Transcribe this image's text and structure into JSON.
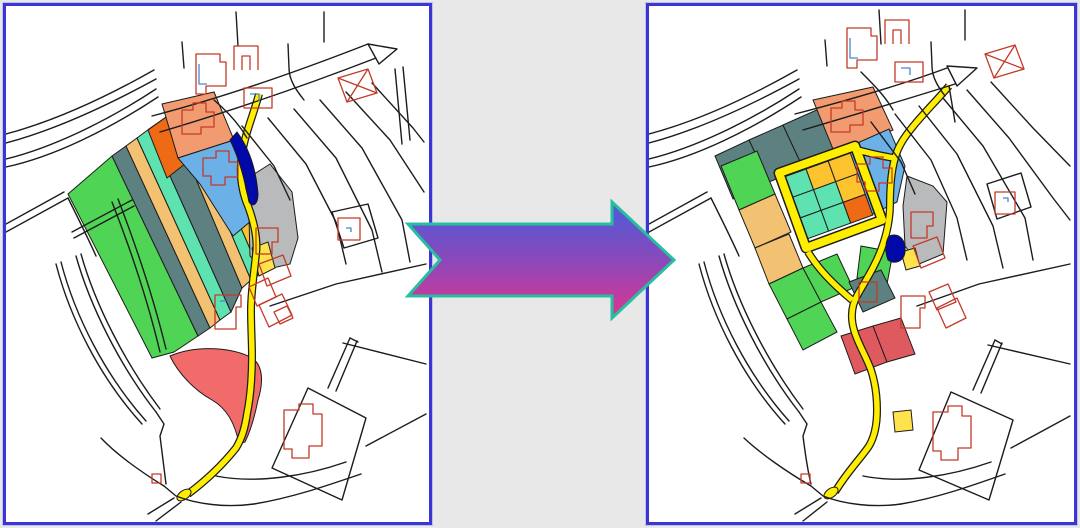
{
  "figure": {
    "kind": "before-after cadastral map comparison",
    "panel_count": 2,
    "arrow_direction": "right"
  },
  "colors": {
    "background": "#e8e8e8",
    "panel_bg": "#ffffff",
    "panel_border": "#3b35d6",
    "line": "#1c1c1c",
    "building": "#c43a28",
    "building_detail": "#4a86c8",
    "road": "#ffee00",
    "water": "#0008a8",
    "green": "#4fd455",
    "slate": "#5d8181",
    "tan": "#f2c272",
    "mint": "#5ee3b0",
    "gold": "#fcc32e",
    "orange": "#ee6a14",
    "salmon": "#f29b70",
    "blue": "#6cb0e8",
    "gray": "#b9babc",
    "red_blob": "#f26b6b",
    "red": "#df5a5e",
    "yellow_parcel": "#ffe34d"
  },
  "arrow": {
    "outline": "#27bfa0",
    "gradient_start": "#4a5cdb",
    "gradient_mid": "#8a49bb",
    "gradient_end": "#e1338f"
  }
}
